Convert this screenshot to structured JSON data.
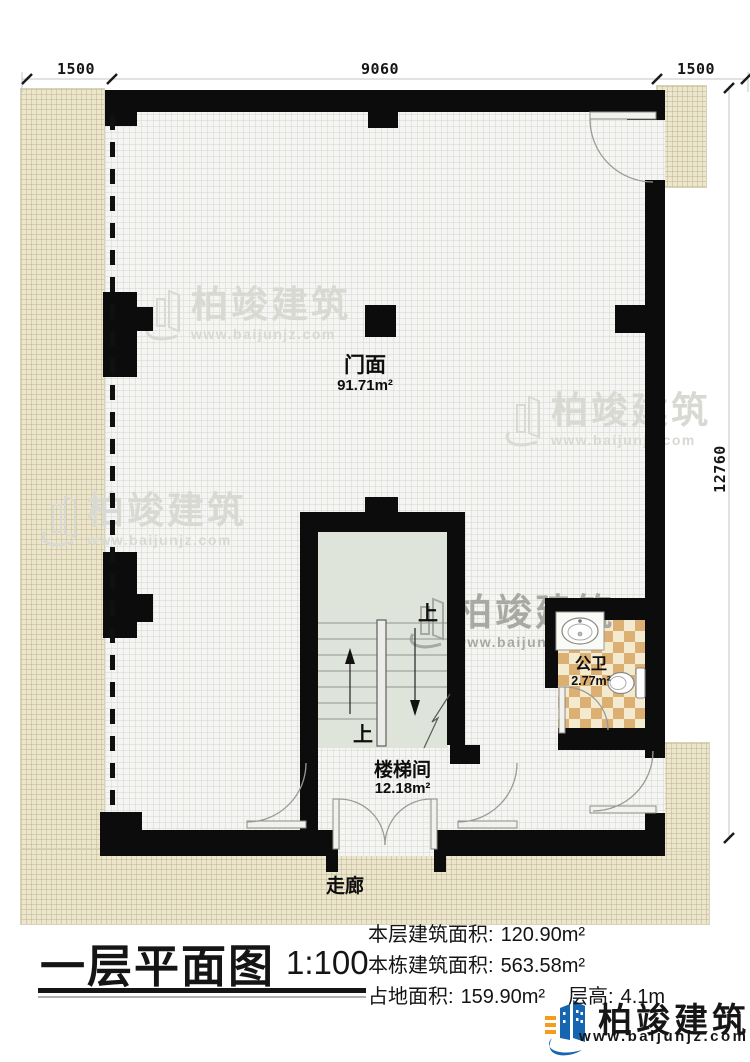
{
  "title": {
    "text": "一层平面图",
    "scale": "1:100"
  },
  "dimensions": {
    "top_left": "1500",
    "top_middle": "9060",
    "top_right": "1500",
    "right_side": "12760"
  },
  "rooms": {
    "shop": {
      "name": "门面",
      "area": "91.71m²"
    },
    "stairwell": {
      "name": "楼梯间",
      "area": "12.18m²",
      "up_label": "上"
    },
    "toilet": {
      "name": "公卫",
      "area": "2.77m²"
    },
    "corridor": {
      "name": "走廊"
    }
  },
  "stats": {
    "floor_area_label": "本层建筑面积:",
    "floor_area_value": "120.90m²",
    "building_area_label": "本栋建筑面积:",
    "building_area_value": "563.58m²",
    "footprint_label": "占地面积:",
    "footprint_value": "159.90m²",
    "height_label": "层高:",
    "height_value": "4.1m"
  },
  "brand": {
    "name": "柏竣建筑",
    "url": "www.baijunjz.com"
  },
  "colors": {
    "wall": "#0c0c0c",
    "hatch": "#ebe6cd",
    "stair_floor": "#dee4da",
    "tile_dark": "#dcaf73",
    "tile_light": "#f4ead0",
    "logo_blue": "#1565b0",
    "logo_orange": "#f59d1a"
  }
}
